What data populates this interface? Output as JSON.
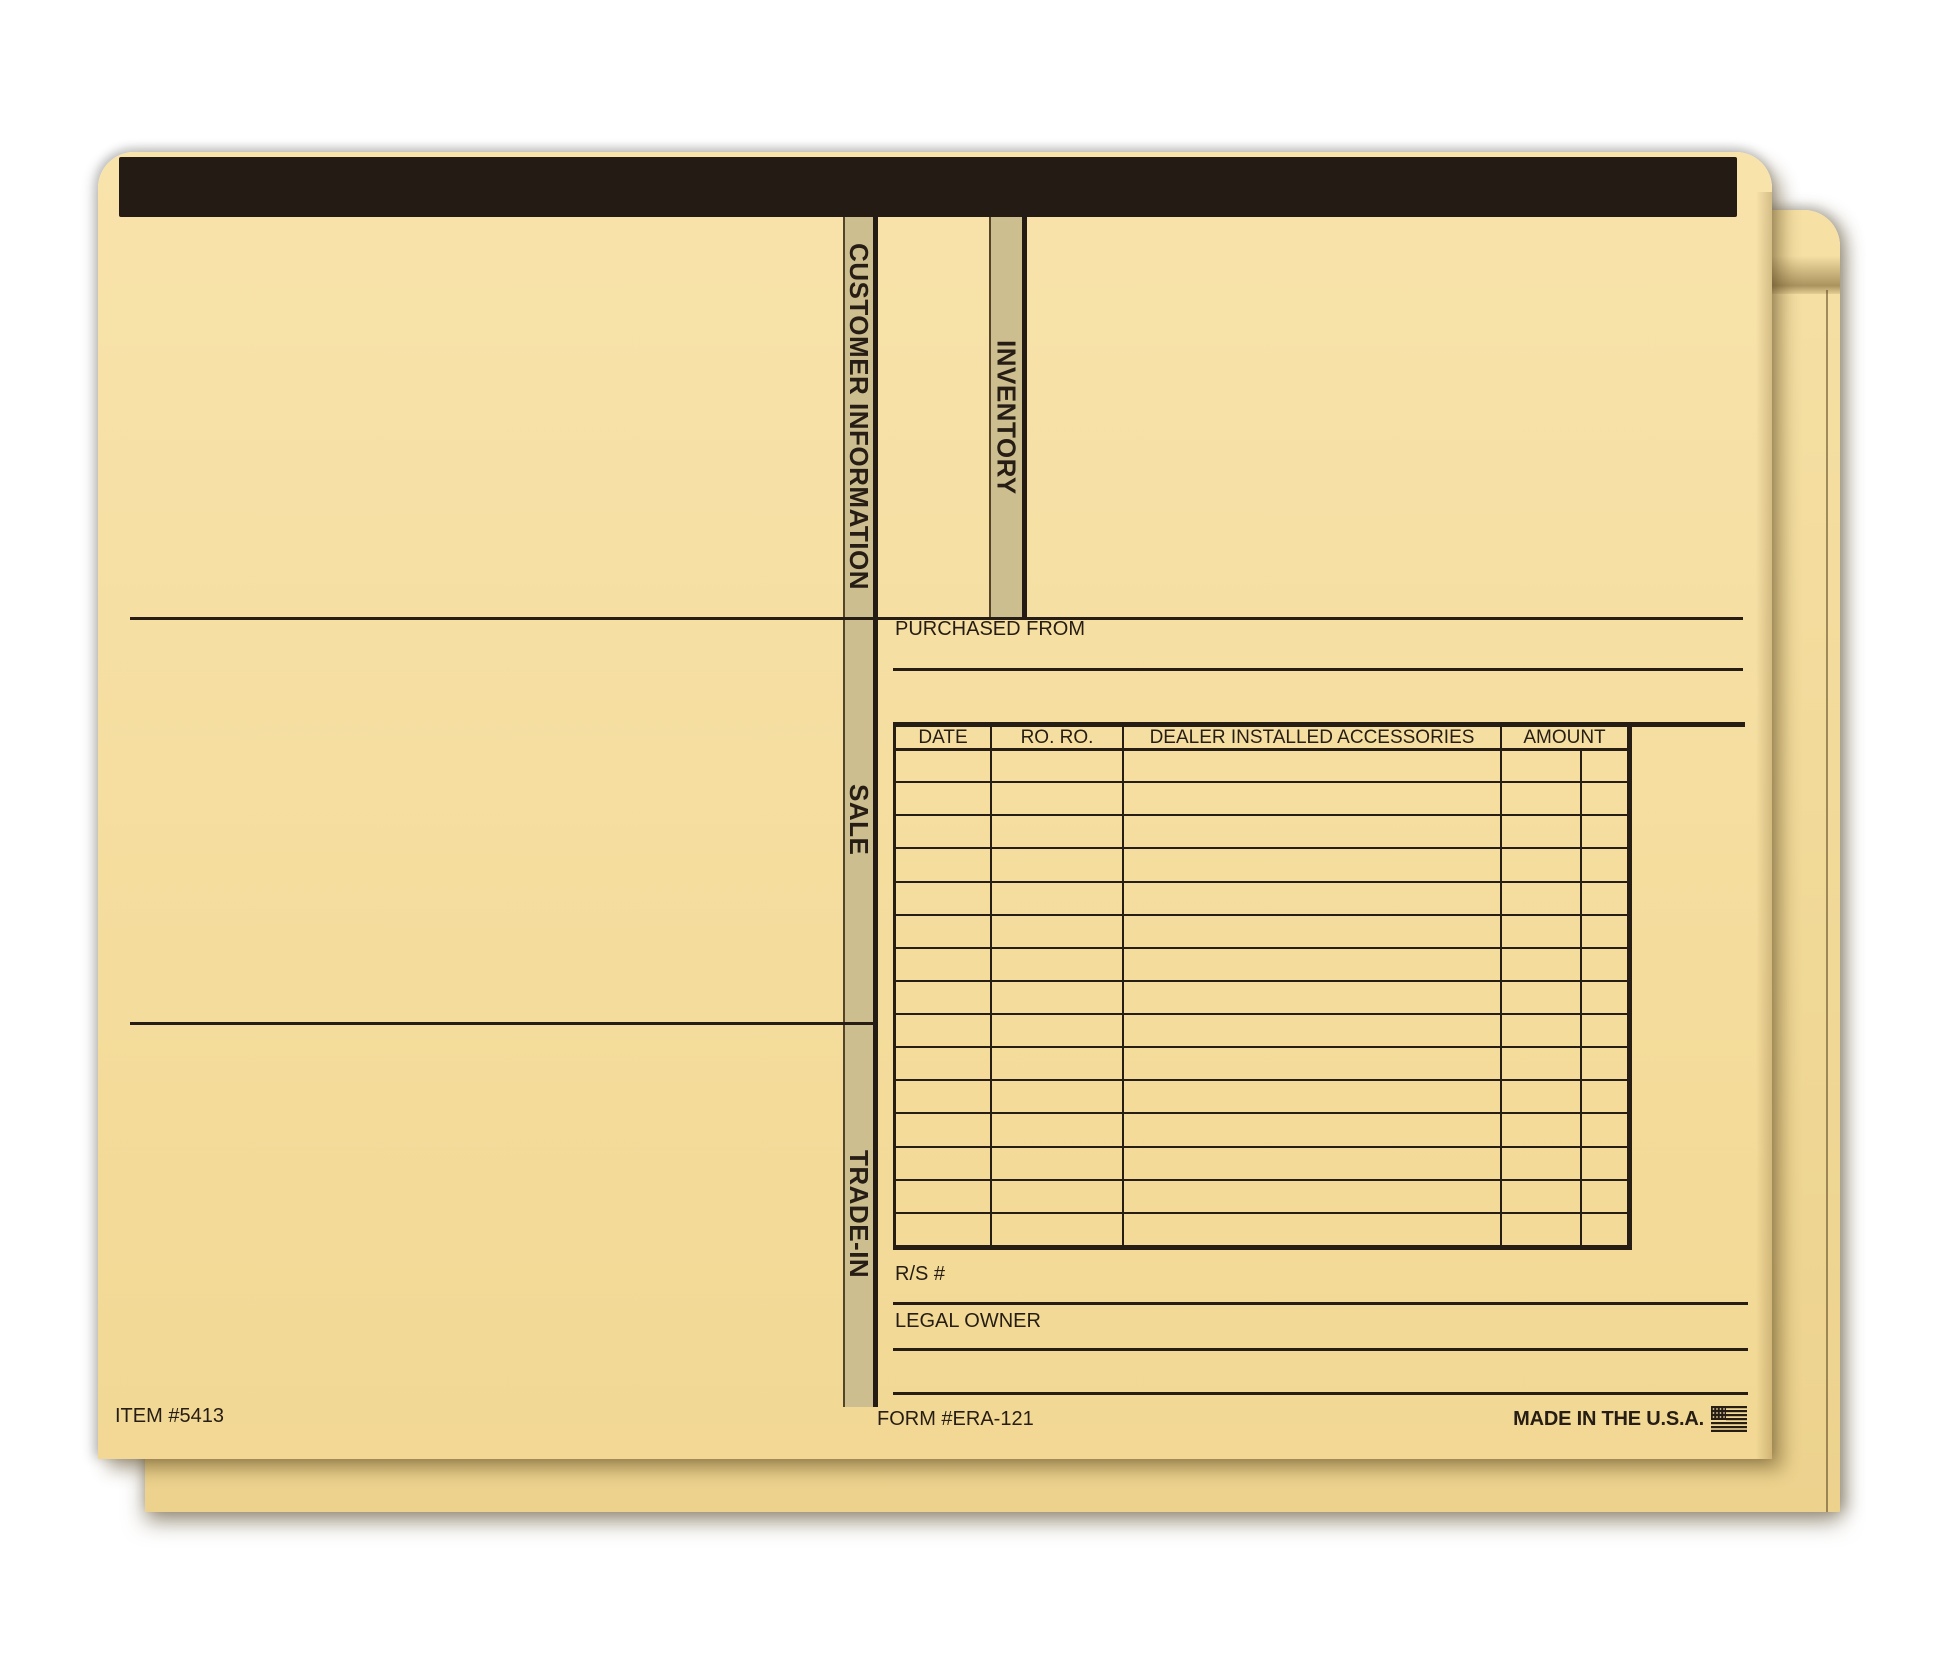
{
  "tabs": {
    "customer_information": "CUSTOMER INFORMATION",
    "inventory": "INVENTORY",
    "sale": "SALE",
    "trade_in": "TRADE-IN"
  },
  "purchased_from": {
    "label": "PURCHASED FROM"
  },
  "table": {
    "headers": [
      "DATE",
      "RO. RO.",
      "DEALER INSTALLED ACCESSORIES",
      "AMOUNT"
    ],
    "row_count": 15,
    "rows": []
  },
  "fields": {
    "rs": "R/S #",
    "legal_owner": "LEGAL OWNER"
  },
  "footer": {
    "item": "ITEM #5413",
    "form": "FORM #ERA-121",
    "made_in": "MADE IN THE U.S.A.",
    "flag_icon": "us-flag-icon"
  },
  "colors": {
    "manila_top": "#f8e3ab",
    "manila_bottom": "#f2d894",
    "back_top": "#f6e0a4",
    "back_bottom": "#ecd28d",
    "strip": "#cdbe90",
    "ink": "#261d14",
    "bar": "#241b14"
  }
}
